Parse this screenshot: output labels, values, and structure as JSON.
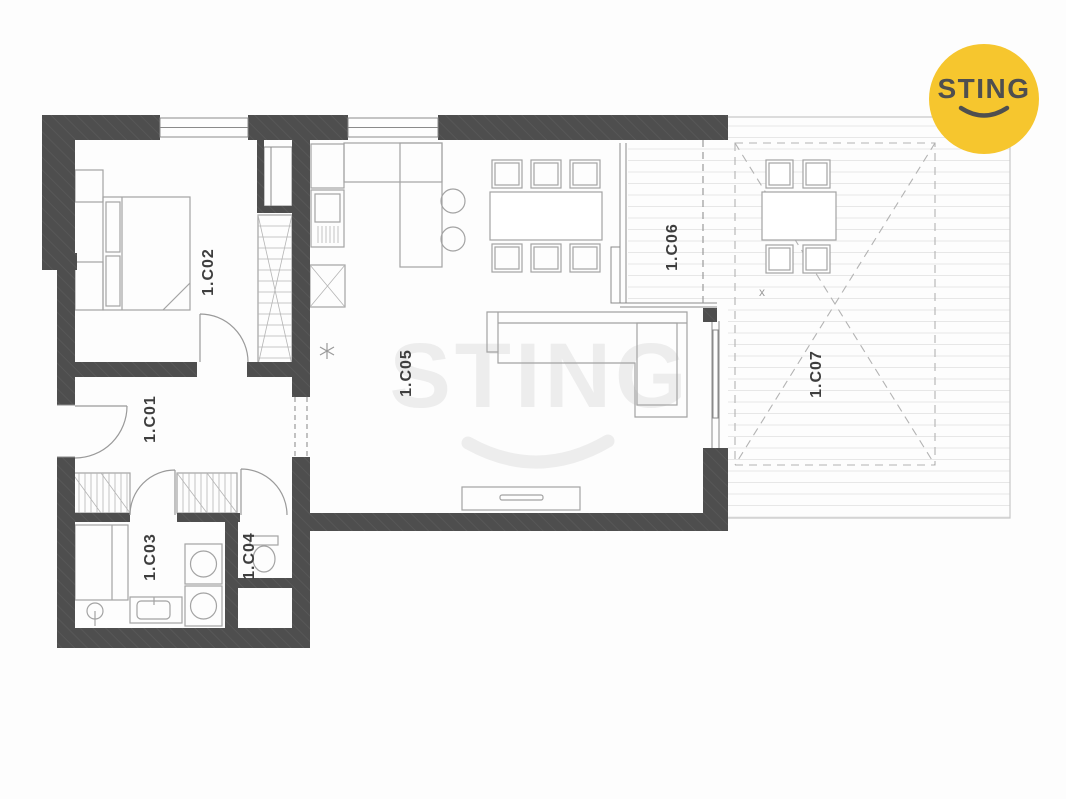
{
  "rooms": [
    {
      "label": "1.C01"
    },
    {
      "label": "1.C02"
    },
    {
      "label": "1.C03"
    },
    {
      "label": "1.C04"
    },
    {
      "label": "1.C05"
    },
    {
      "label": "1.C06"
    },
    {
      "label": "1.C07"
    }
  ],
  "watermark": {
    "text": "STING"
  },
  "logo": {
    "brand": "STING"
  },
  "markers": {
    "terrace_cross": "x"
  },
  "colors": {
    "wall": "#4e4e4e",
    "logo_circle": "#f6c62e",
    "logo_text": "#4f4f4f",
    "watermark": "#ededed",
    "furniture_line": "#a3a3a3",
    "decking_line": "#e7e7e7"
  }
}
